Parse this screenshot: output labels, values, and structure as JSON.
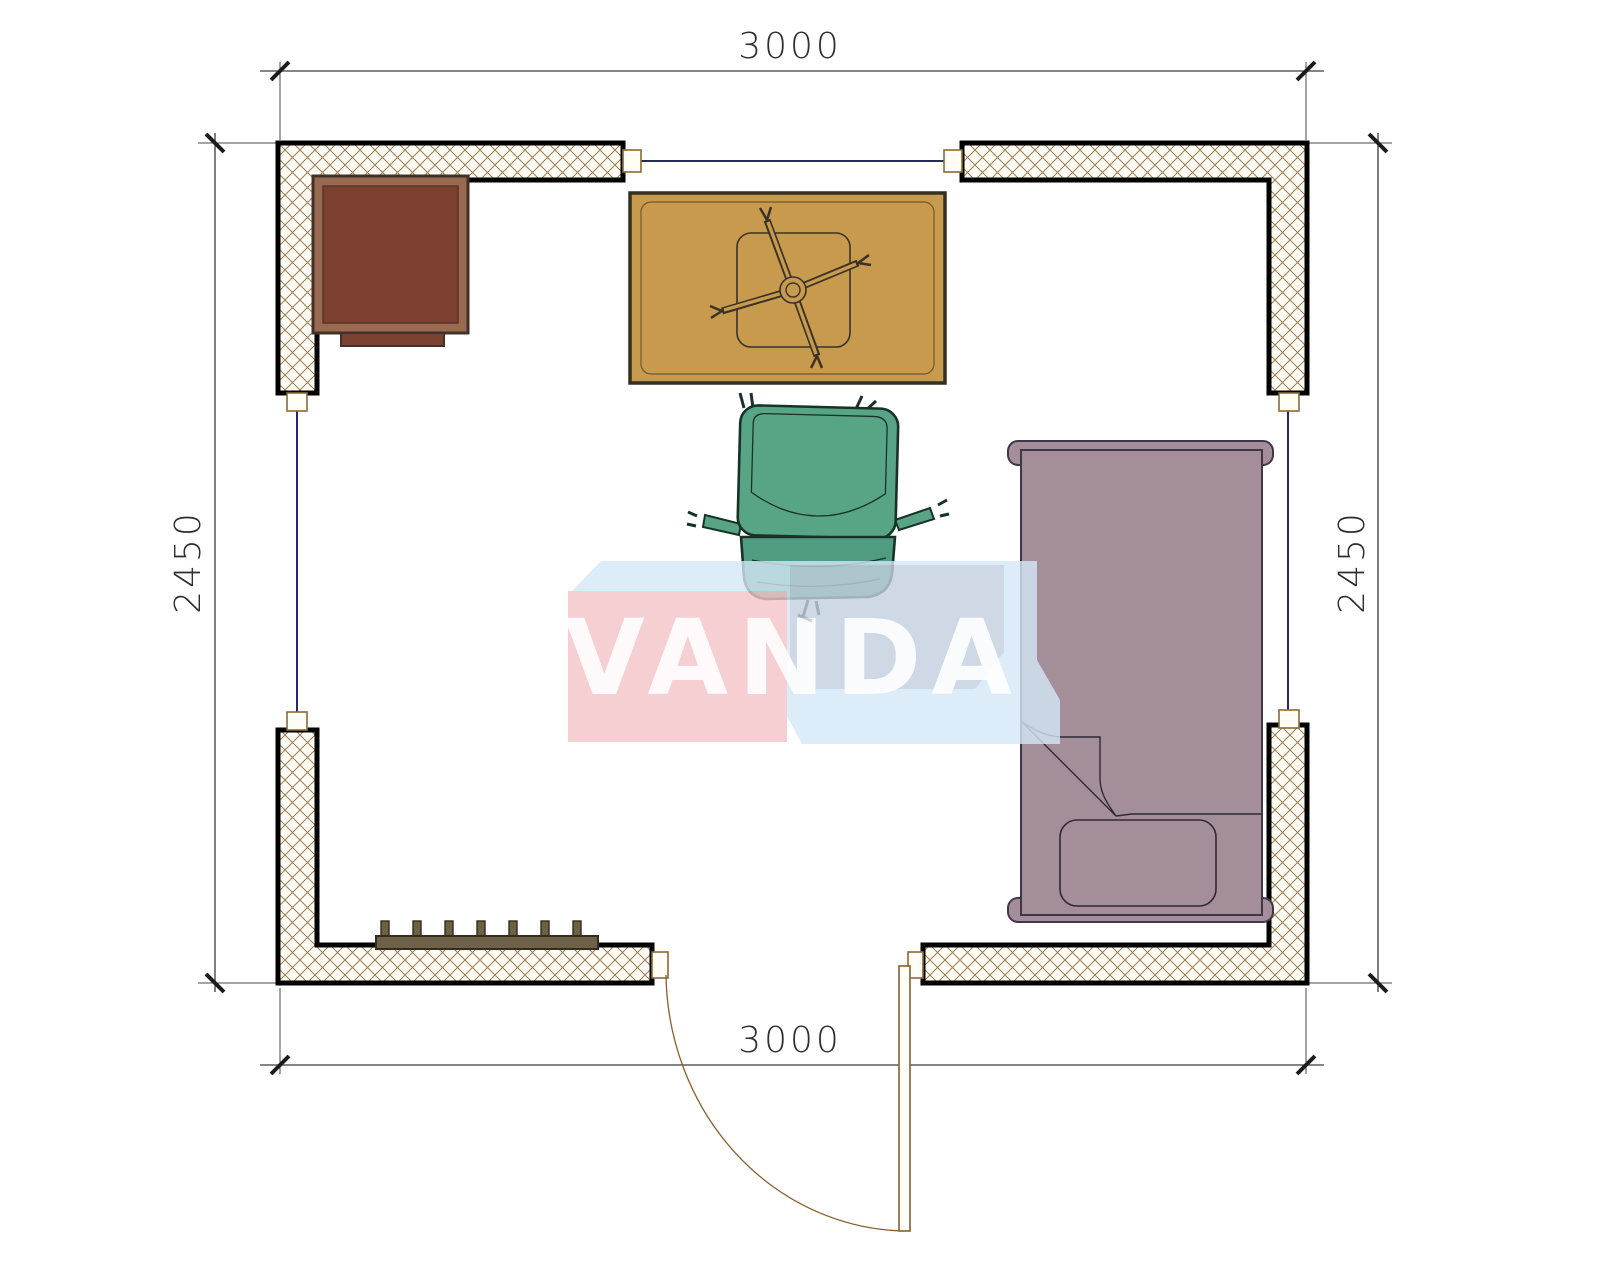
{
  "document": {
    "type": "floor-plan",
    "brand_watermark": "VANDA"
  },
  "dimensions": {
    "top": "3000",
    "bottom": "3000",
    "left": "2450",
    "right": "2450"
  },
  "room": {
    "width_mm": 3000,
    "depth_mm": 2450
  },
  "watermark": {
    "text": "VANDA",
    "pink_face": "#f5c4c9",
    "light_blue_face": "#d4e8f7",
    "gray_blue_face": "#c4d0df",
    "text_color": "#ffffff"
  },
  "palette": {
    "background": "#ffffff",
    "wall_fill": "#fffdf6",
    "wall_hatch": "#9b7b51",
    "wall_border": "#000000",
    "window_line": "#28286d",
    "jamb_outline": "#8b6a34",
    "door_outline": "#8b5e2c",
    "dim_line": "#3a3a3a",
    "cabinet_frame": "#9a6a50",
    "cabinet_fill": "#7c4030",
    "table_fill": "#c79a4d",
    "table_outline": "#3a3226",
    "chair_back_fill": "#58a585",
    "chair_seat_fill": "#4f9c80",
    "chair_outline": "#173229",
    "bed_fill": "#a38e9a",
    "bed_outline": "#40374a",
    "radiator_fill": "#6e6148"
  },
  "furniture": [
    {
      "icon": "cabinet-icon",
      "label": "corner cabinet"
    },
    {
      "icon": "table-icon",
      "label": "table with chair base"
    },
    {
      "icon": "office-chair-icon",
      "label": "office chair"
    },
    {
      "icon": "bed-icon",
      "label": "single bed with pillow"
    },
    {
      "icon": "radiator-icon",
      "label": "radiator"
    },
    {
      "icon": "door-icon",
      "label": "outward swinging door"
    },
    {
      "icon": "window-icon",
      "label": "windows on three walls"
    }
  ]
}
